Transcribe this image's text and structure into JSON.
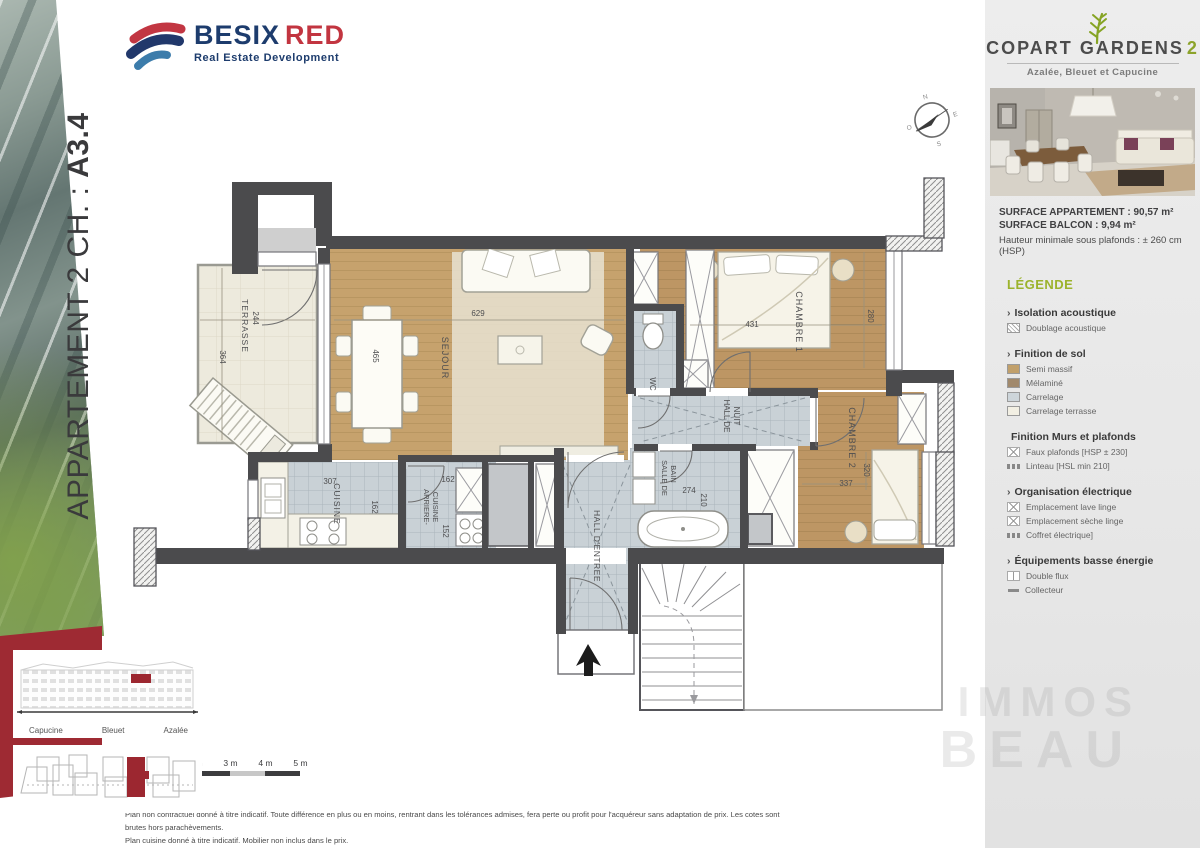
{
  "left_panel": {
    "title_prefix": "APPARTEMENT 2 CH. : ",
    "title_code": "A3.4"
  },
  "logo": {
    "besix": "BESIX",
    "red": "RED",
    "tagline": "Real Estate Development"
  },
  "compass": {
    "n": "N",
    "e": "E",
    "s": "S",
    "o": "O"
  },
  "plan": {
    "rooms": {
      "terrasse": {
        "label": "TERRASSE",
        "dim_a": "244",
        "dim_b": "364"
      },
      "sejour": {
        "label": "SEJOUR",
        "dim_a": "629",
        "dim_b": "465"
      },
      "wc": {
        "label": "WC"
      },
      "chambre1": {
        "label": "CHAMBRE 1",
        "dim_a": "431",
        "dim_b": "280"
      },
      "hall_de_nuit": {
        "label_line1": "HALL DE",
        "label_line2": "NUIT"
      },
      "chambre2": {
        "label": "CHAMBRE 2",
        "dim_a": "320",
        "dim_b": "337"
      },
      "cuisine": {
        "label": "CUISINE",
        "dim_a": "307",
        "dim_b": "162"
      },
      "arriere_cuisine": {
        "label_line1": "ARRIERE-",
        "label_line2": "CUISINE",
        "dim_a": "162",
        "dim_b": "152"
      },
      "salle_de_bain": {
        "label_line1": "SALLE DE",
        "label_line2": "BAIN",
        "dim_a": "274",
        "dim_b": "210"
      },
      "hall_entree": {
        "label": "HALL D'ENTREE"
      }
    },
    "scale_labels": [
      "1 m",
      "2 m",
      "3 m",
      "4 m",
      "5 m"
    ],
    "disclaimer_line1": "Plan non contractuel donné à titre indicatif. Toute différence en plus ou en moins, rentrant dans les tolérances admises, fera perte ou profit pour l'acquéreur sans adaptation de prix. Les cotes sont brutes hors parachèvements.",
    "disclaimer_line2": "Plan cuisine donné à titre indicatif. Mobilier non inclus dans le prix."
  },
  "sidebar": {
    "project": {
      "name1": "COPART",
      "name2": "GARDENS",
      "number": "2",
      "subtitle": "Azalée, Bleuet et Capucine"
    },
    "surface": {
      "line1": "SURFACE APPARTEMENT : 90,57 m²",
      "line2": "SURFACE BALCON : 9,94 m²",
      "line3": "Hauteur minimale sous plafonds : ± 260 cm (HSP)"
    },
    "legend": {
      "title": "LÉGENDE",
      "sections": [
        {
          "prefix": "›",
          "title": "Isolation acoustique",
          "items": [
            {
              "label": "Doublage acoustique"
            }
          ]
        },
        {
          "prefix": "›",
          "title": "Finition de sol",
          "items": [
            {
              "label": "Semi massif",
              "color": "#c1a06b"
            },
            {
              "label": "Mélaminé",
              "color": "#a1896c"
            },
            {
              "label": "Carrelage",
              "color": "#cdd5da"
            },
            {
              "label": "Carrelage terrasse",
              "color": "#f2efe3"
            }
          ]
        },
        {
          "prefix": "",
          "title": "Finition Murs et plafonds",
          "items": [
            {
              "label": "Faux plafonds [HSP ± 230]"
            },
            {
              "label": "Linteau [HSL min 210]"
            }
          ]
        },
        {
          "prefix": "›",
          "title": "Organisation électrique",
          "items": [
            {
              "label": "Emplacement lave linge"
            },
            {
              "label": "Emplacement sèche linge"
            },
            {
              "label": "Coffret électrique]"
            }
          ]
        },
        {
          "prefix": "›",
          "title": "Équipements basse énergie",
          "items": [
            {
              "label": "Double flux"
            },
            {
              "label": "Collecteur"
            }
          ]
        }
      ]
    },
    "buildings": {
      "b1": "Capucine",
      "b2": "Bleuet",
      "b3": "Azalée"
    },
    "watermark": {
      "line1": "IMMOS",
      "line2": "BEAU"
    }
  }
}
